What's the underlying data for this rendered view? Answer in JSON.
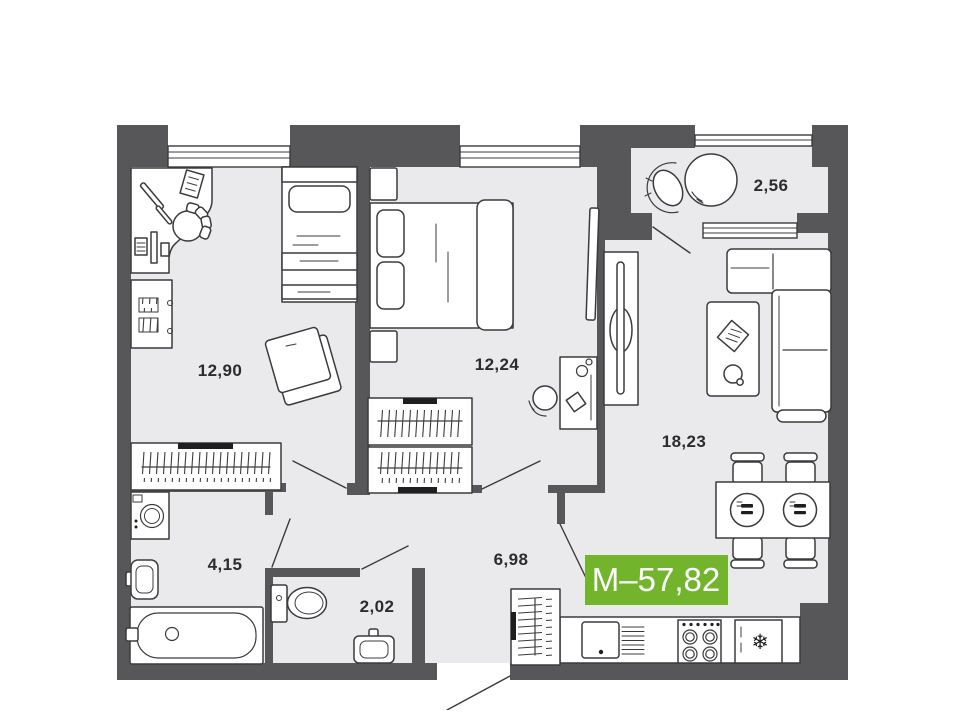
{
  "plan": {
    "badge": {
      "text": "М–57,82",
      "color": "#72b52d"
    },
    "rooms": [
      {
        "id": "bedroom-1",
        "area": "12,90"
      },
      {
        "id": "bedroom-2",
        "area": "12,24"
      },
      {
        "id": "balcony",
        "area": "2,56"
      },
      {
        "id": "living-kitchen",
        "area": "18,23"
      },
      {
        "id": "bathroom",
        "area": "4,15"
      },
      {
        "id": "wc",
        "area": "2,02"
      },
      {
        "id": "hallway",
        "area": "6,98"
      }
    ],
    "icons": {
      "fridge_snowflake": "❄"
    },
    "colors": {
      "wall": "#57575a",
      "floor": "#eaeaec",
      "outline": "#3b3b3d",
      "accent_green": "#72b52d"
    }
  }
}
